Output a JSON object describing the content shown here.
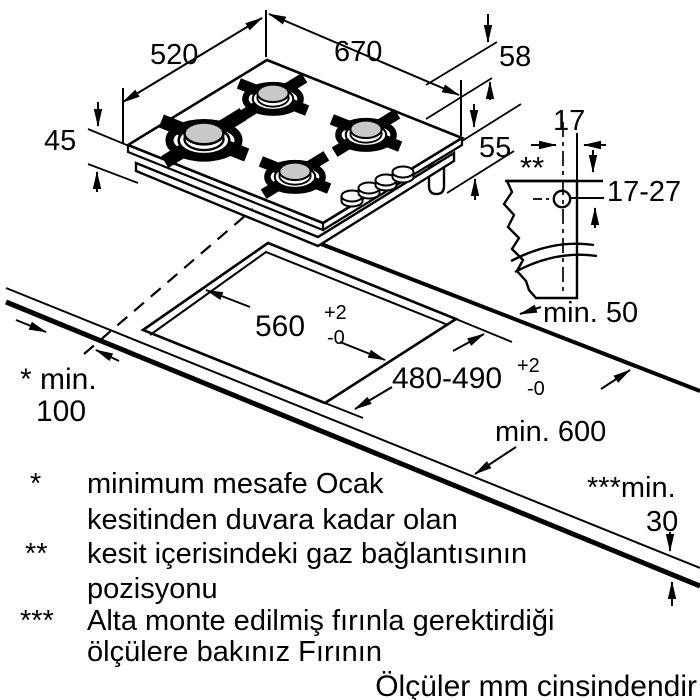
{
  "colors": {
    "background": "#ffffff",
    "ink": "#000000",
    "burner_cap": "#c8c8c8"
  },
  "hob": {
    "width_label": "670",
    "depth_label": "520",
    "height_label": "45",
    "support_height_label": "58",
    "body_height_label": "55"
  },
  "gas_connection": {
    "marker": "**",
    "horizontal_label": "17",
    "vertical_label": "17-27"
  },
  "cutout": {
    "width": {
      "value": "560",
      "tol_plus": "+2",
      "tol_minus": "-0"
    },
    "depth": {
      "value": "480-490",
      "tol_plus": "+2",
      "tol_minus": "-0"
    }
  },
  "clearances": {
    "side": {
      "line1": "* min.",
      "line2": "100"
    },
    "rear": "min. 50",
    "worktop_depth": "min. 600",
    "panel": {
      "line1": "***min.",
      "line2": "30"
    }
  },
  "footnotes": [
    {
      "marker": "*",
      "line1": "minimum mesafe Ocak",
      "line2": "kesitinden duvara kadar olan"
    },
    {
      "marker": "**",
      "line1": "kesit içerisindeki gaz bağlantısının",
      "line2": "pozisyonu"
    },
    {
      "marker": "***",
      "line1": "Alta monte edilmiş fırınla gerektirdiği",
      "line2": "ölçülere bakınız Fırının"
    }
  ],
  "units_note": "Ölçüler mm cinsindendir"
}
